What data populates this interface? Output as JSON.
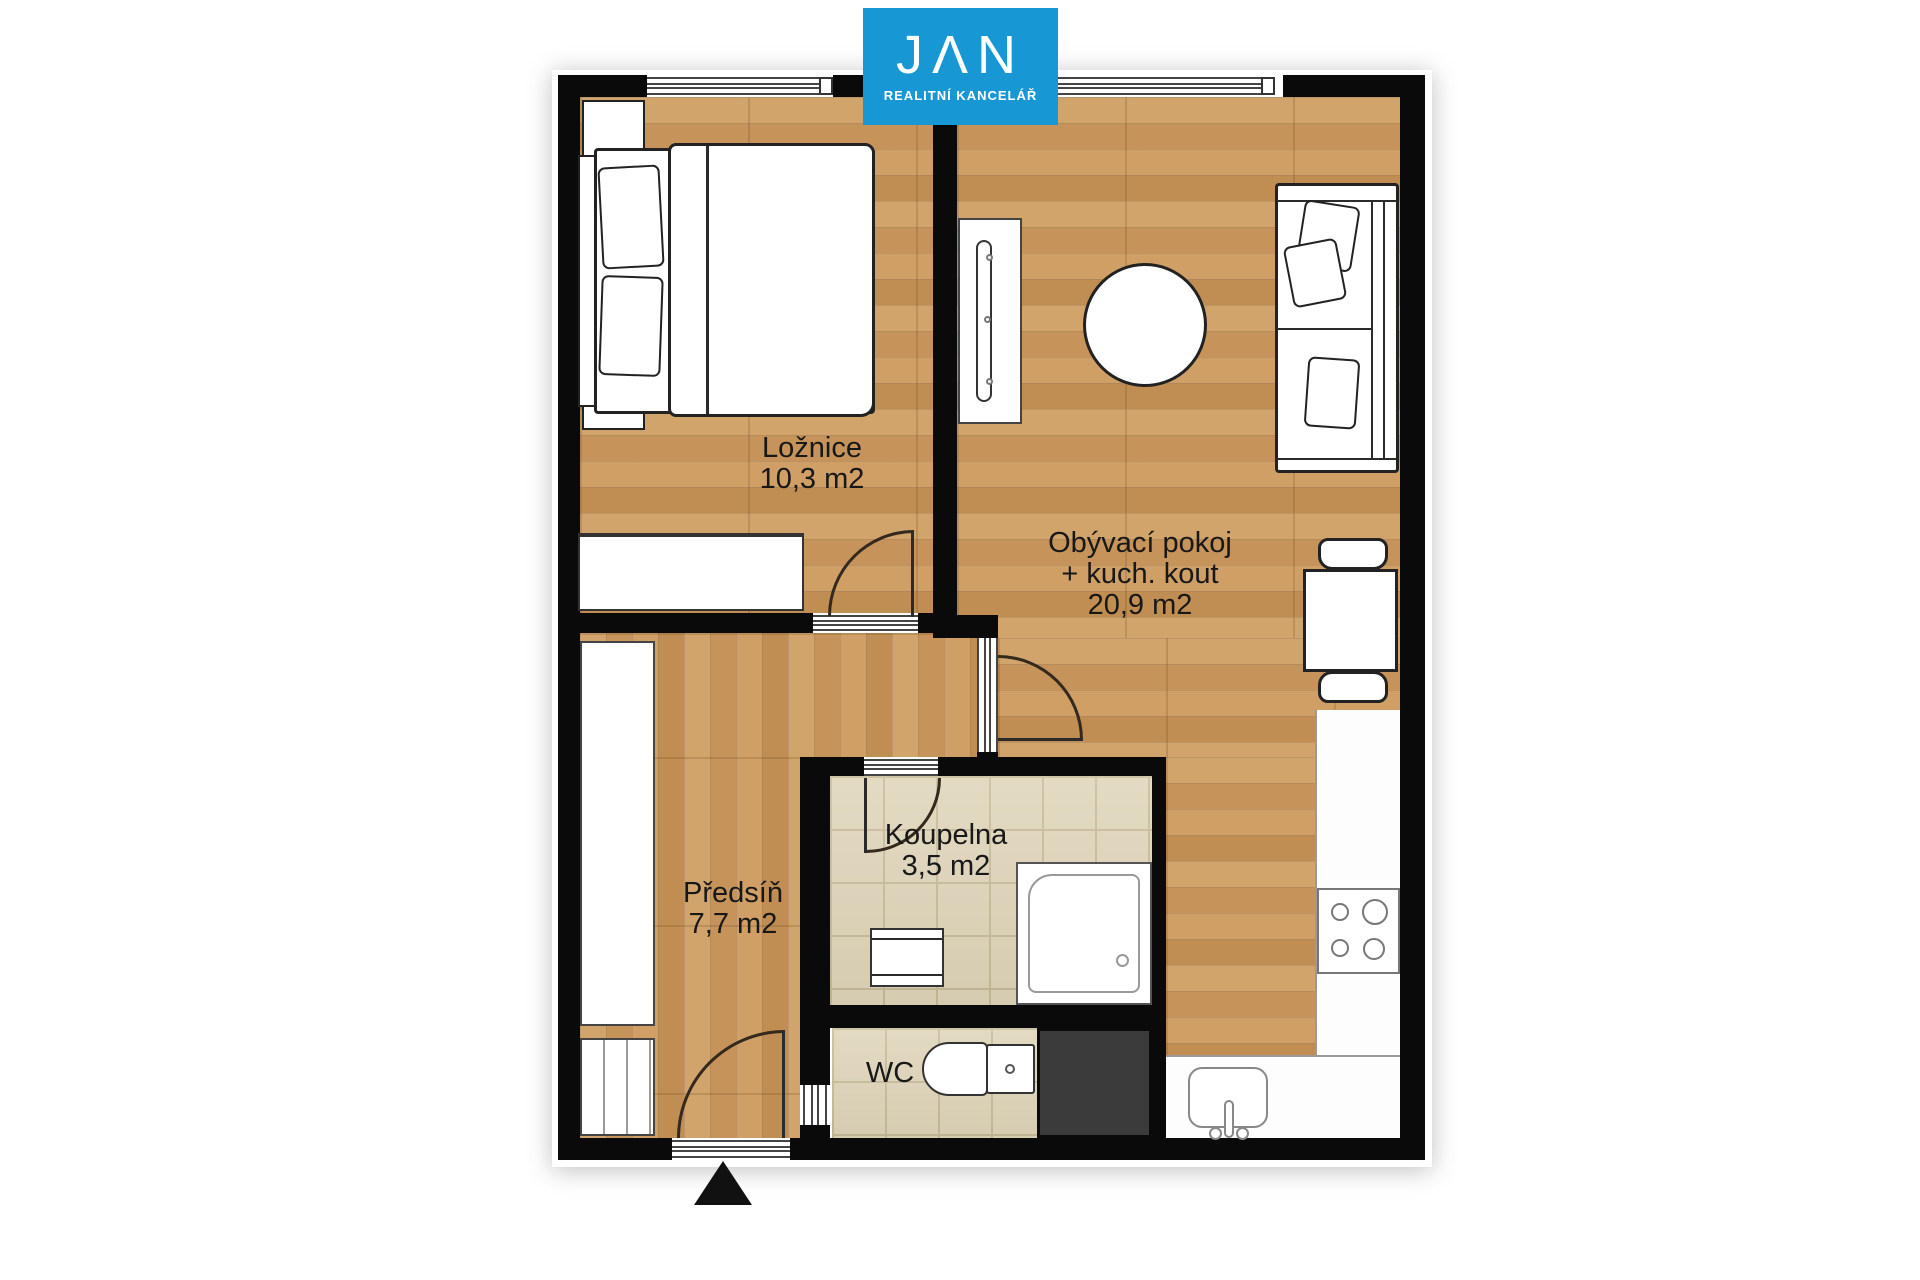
{
  "logo": {
    "letters": [
      "J",
      "Λ",
      "N"
    ],
    "subtitle": "REALITNÍ KANCELÁŘ",
    "background_color": "#1798d4",
    "text_color": "#ffffff"
  },
  "rooms": {
    "bedroom": {
      "name": "Ložnice",
      "area": "10,3 m2"
    },
    "living": {
      "name": "Obývací pokoj",
      "name_line2": "+ kuch. kout",
      "area": "20,9 m2"
    },
    "hall": {
      "name": "Předsíň",
      "area": "7,7 m2"
    },
    "bathroom": {
      "name": "Koupelna",
      "area": "3,5 m2"
    },
    "wc": {
      "name": "WC"
    }
  },
  "colors": {
    "wall": "#0a0a0a",
    "wood_floor": "#c9995f",
    "bathroom_tile": "#ded4b8",
    "utility_shaft": "#3b3b3b",
    "logo_blue": "#1798d4"
  },
  "icons": {
    "entrance_marker": "entrance-arrow-icon"
  }
}
